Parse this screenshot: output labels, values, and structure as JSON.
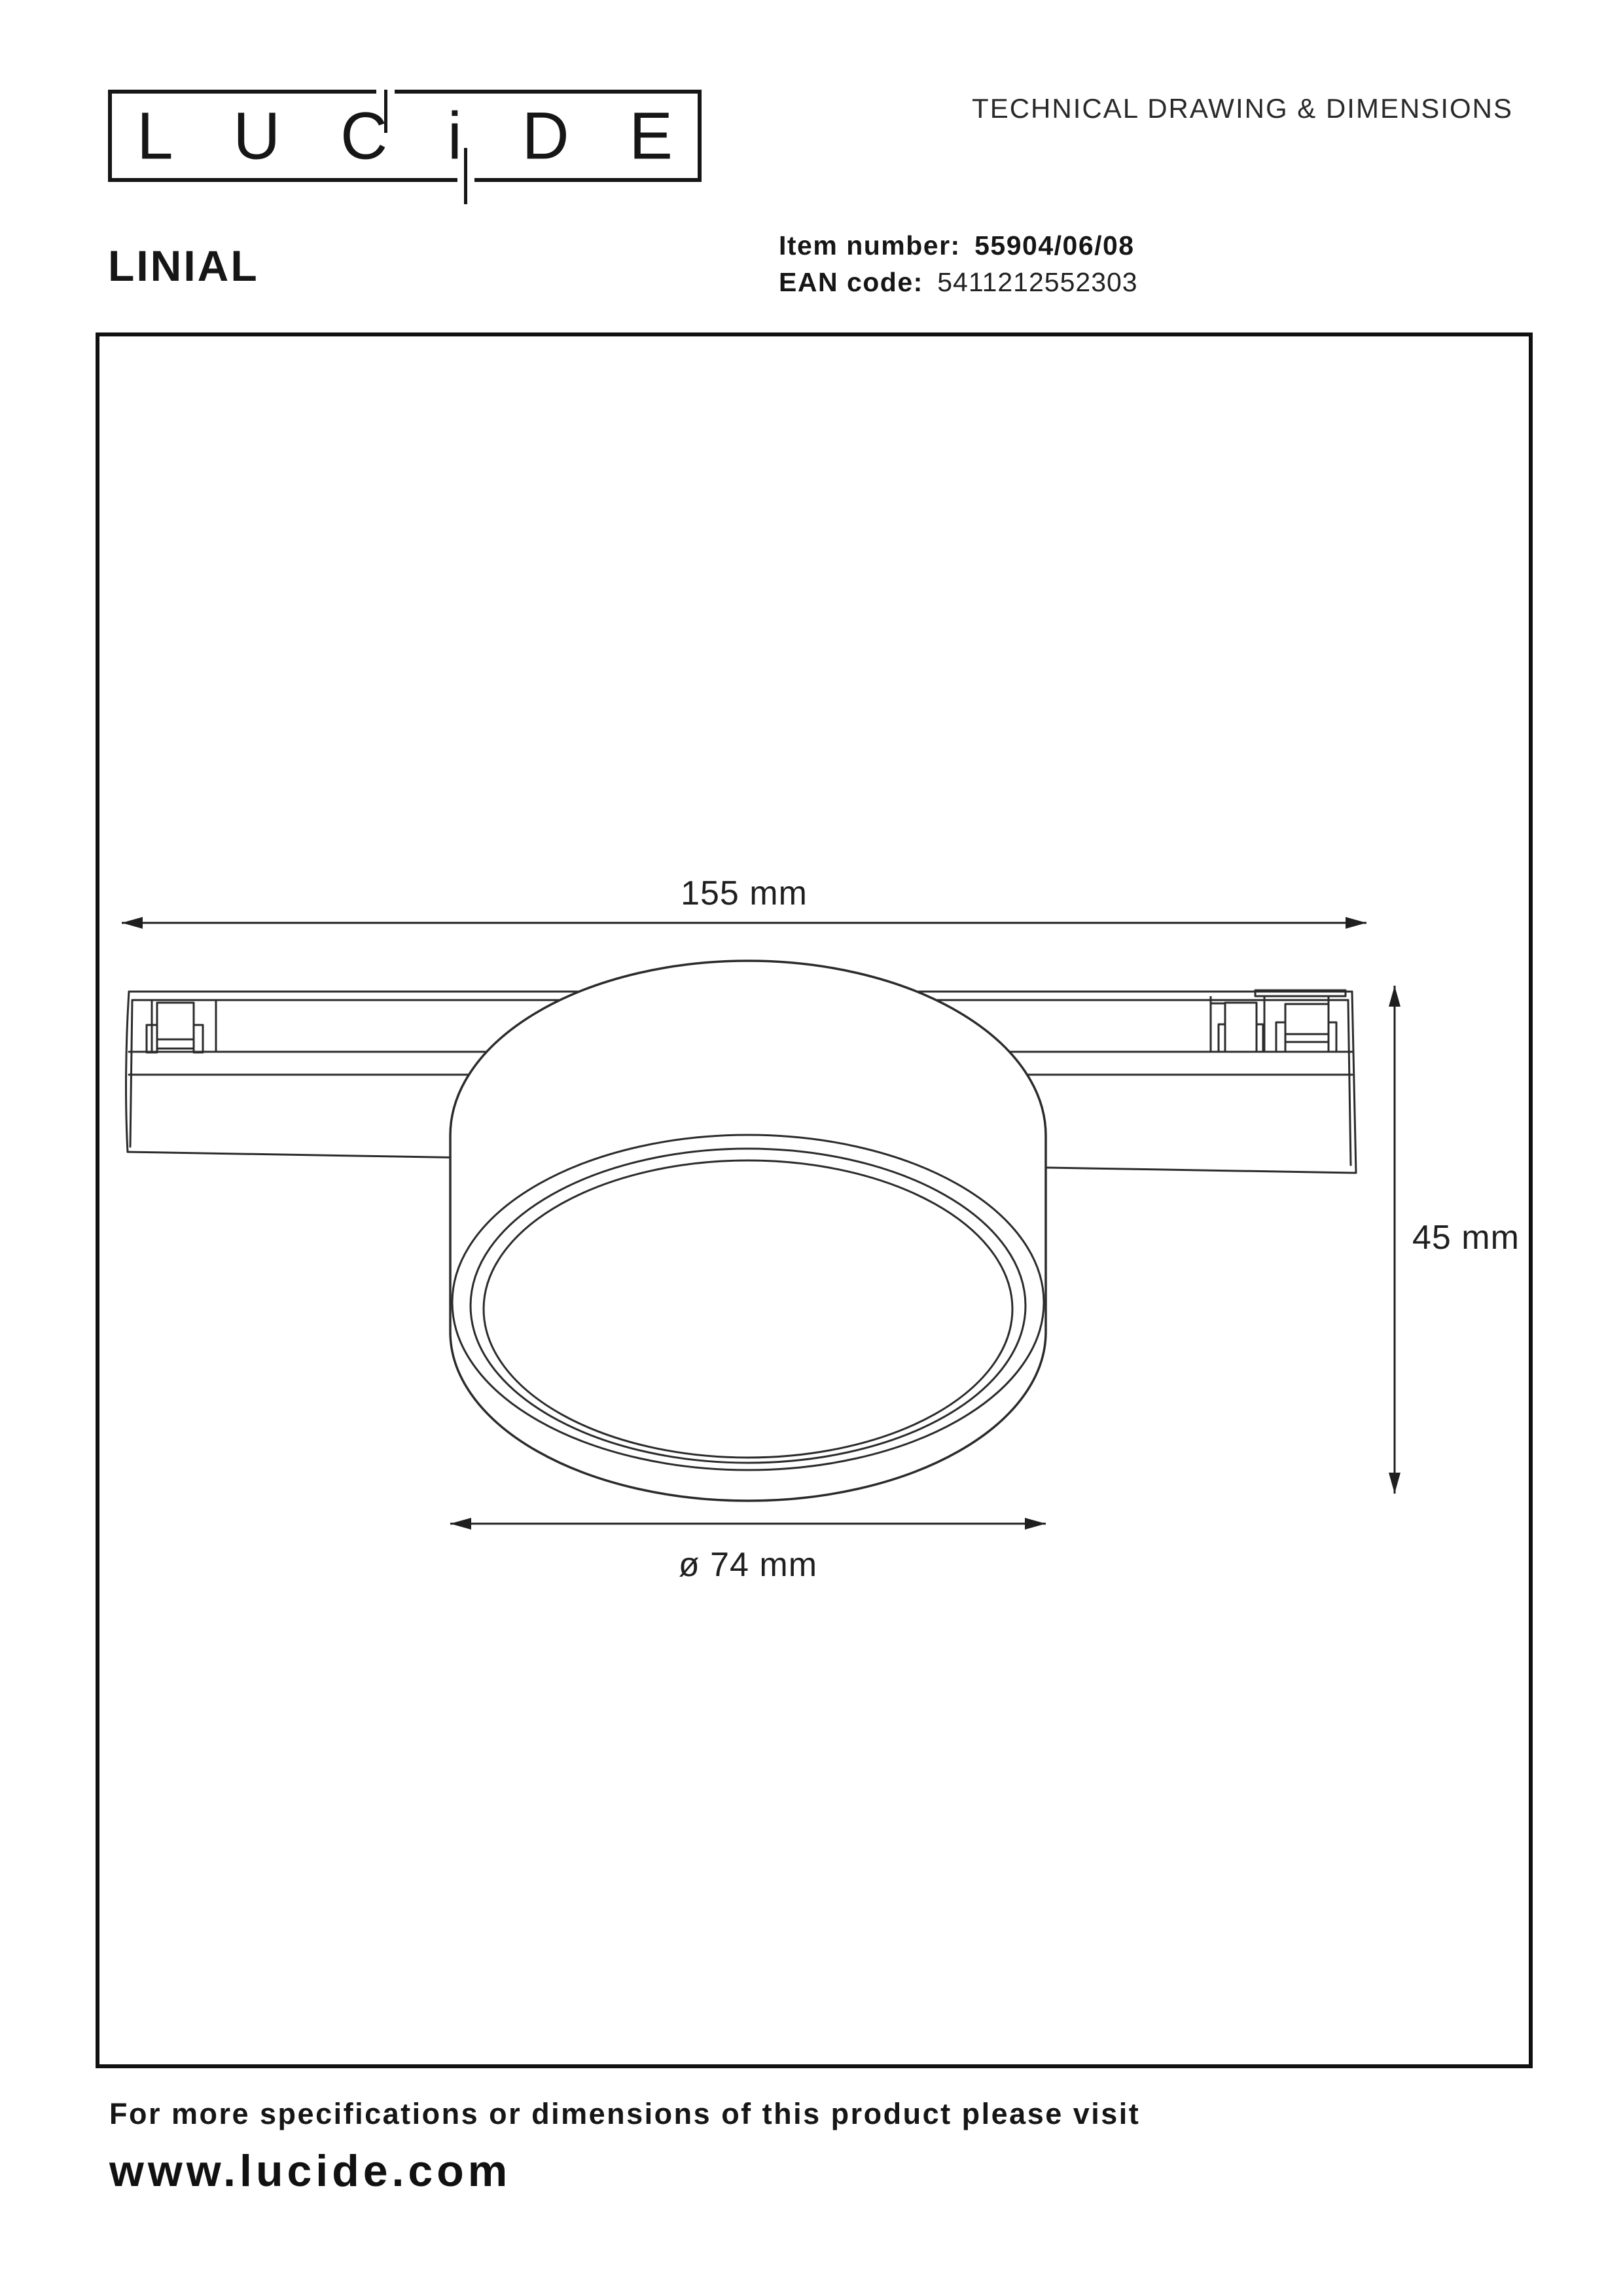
{
  "brand": {
    "logo_letters": [
      "L",
      "U",
      "C",
      "i",
      "D",
      "E"
    ]
  },
  "header": {
    "doc_type": "TECHNICAL DRAWING & DIMENSIONS",
    "product_name": "LINIAL",
    "item_label": "Item number:",
    "item_value": "55904/06/08",
    "ean_label": "EAN code:",
    "ean_value": "5411212552303"
  },
  "drawing": {
    "width_label": "155 mm",
    "height_label": "45 mm",
    "diameter_label": "ø 74 mm"
  },
  "footer": {
    "note": "For more specifications or dimensions of this product please visit",
    "website": "www.lucide.com"
  },
  "colors": {
    "ink": "#161616",
    "line": "#2b2b2b",
    "dimension": "#1f1f1f",
    "background": "#ffffff"
  }
}
